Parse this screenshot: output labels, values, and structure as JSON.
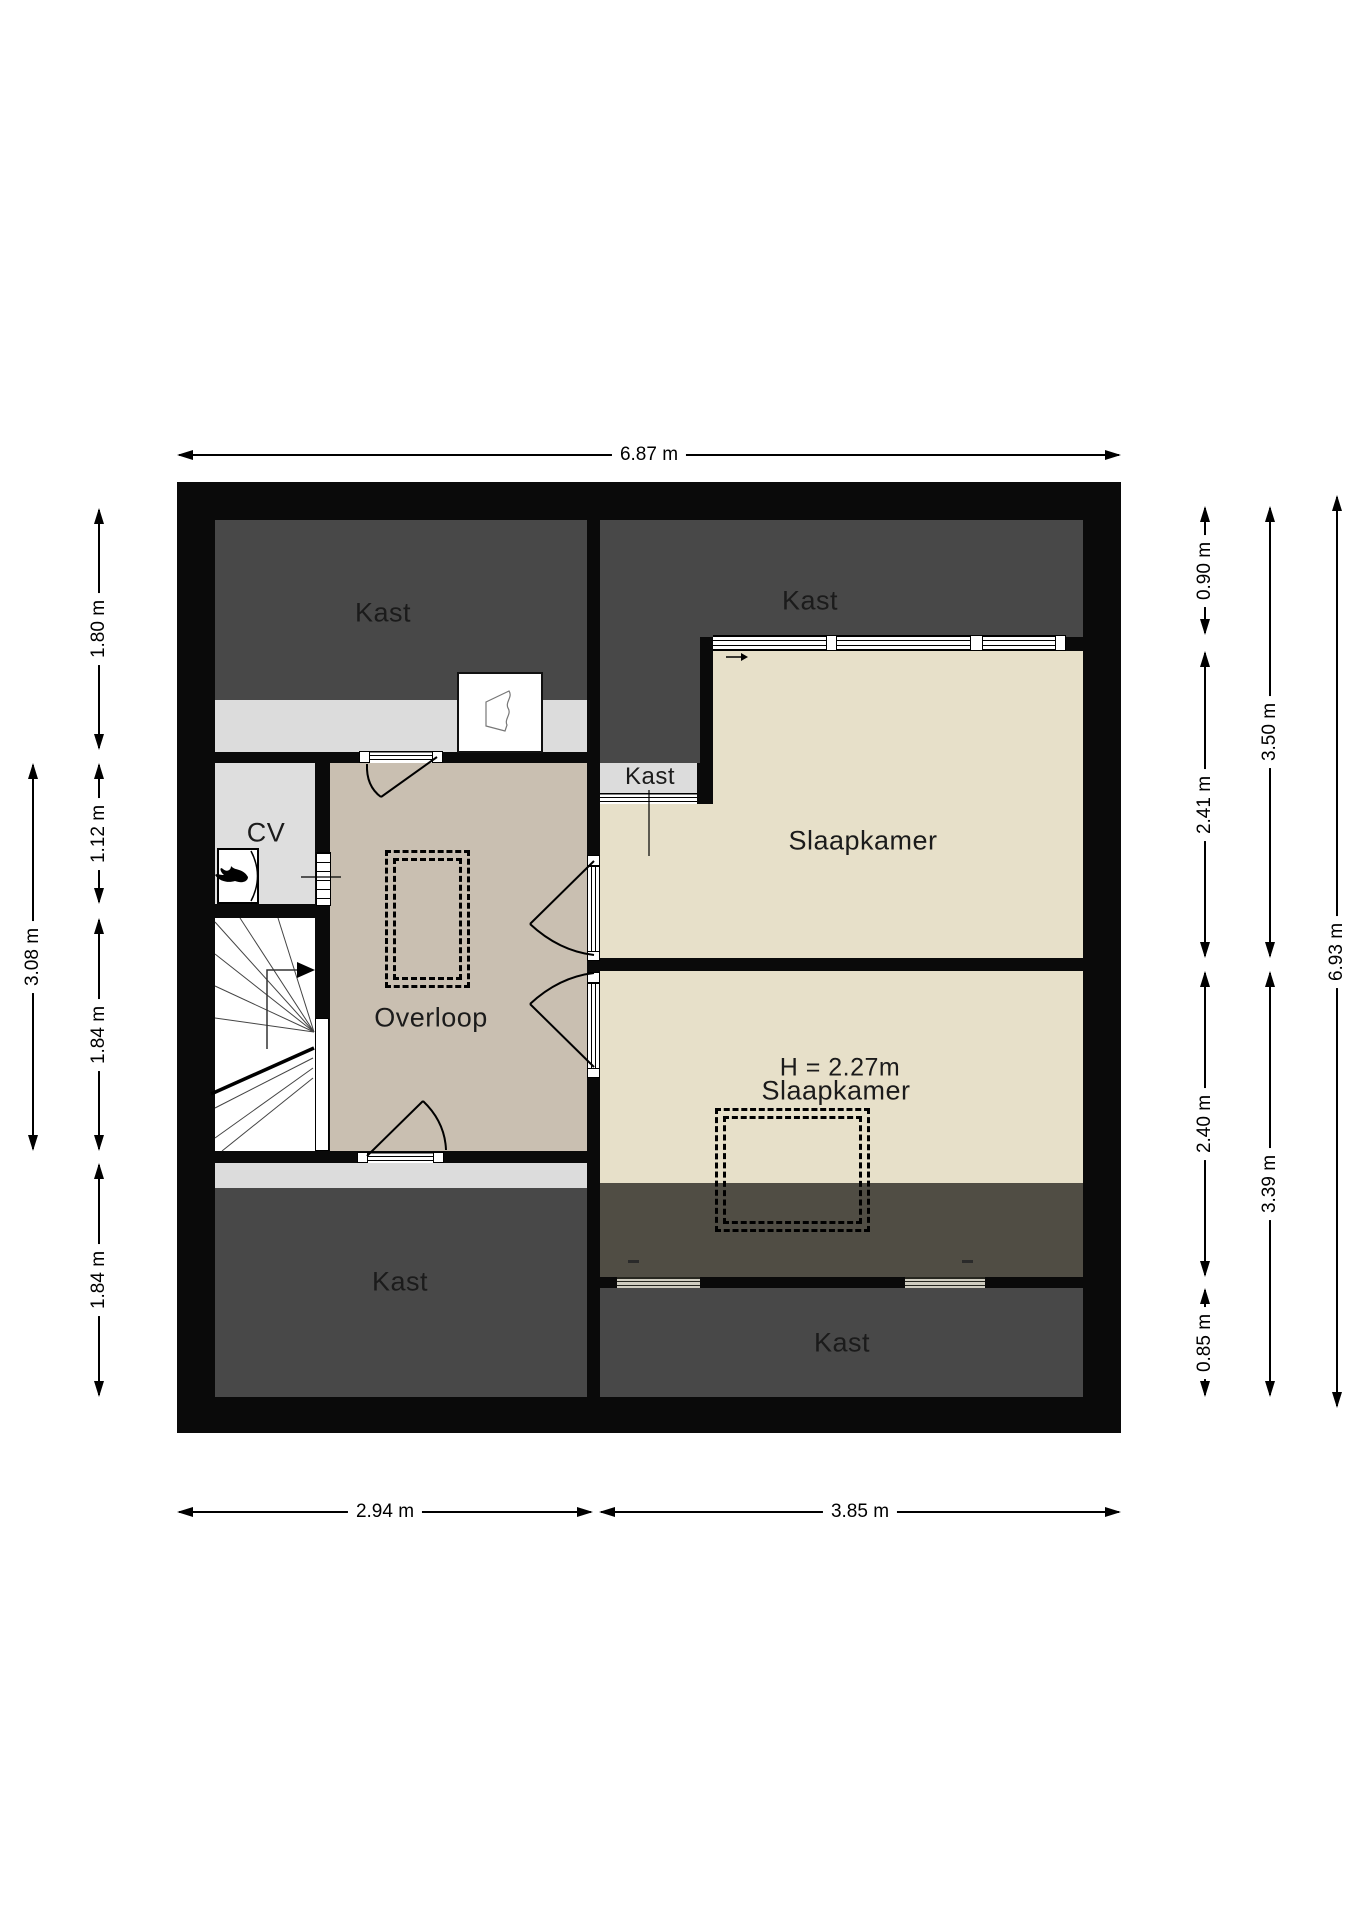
{
  "rooms": {
    "kast_top_left": "Kast",
    "kast_top_right": "Kast",
    "kast_small": "Kast",
    "cv": "CV",
    "overloop": "Overloop",
    "slaapkamer_top": "Slaapkamer",
    "slaapkamer_bottom_height": "H = 2.27m",
    "slaapkamer_bottom": "Slaapkamer",
    "kast_bottom_left": "Kast",
    "kast_bottom": "Kast"
  },
  "dimensions": {
    "top": [
      "6.87 m"
    ],
    "bottom": [
      "2.94 m",
      "3.85 m"
    ],
    "left_inner": [
      "1.80 m",
      "1.12 m",
      "1.84 m",
      "1.84 m"
    ],
    "left_outer": [
      "3.08 m"
    ],
    "right_inner": [
      "0.90 m",
      "2.41 m",
      "2.40 m",
      "0.85 m"
    ],
    "right_middle": [
      "3.50 m",
      "3.39 m"
    ],
    "right_outer": [
      "6.93 m"
    ]
  },
  "colors": {
    "wall": "#0a0a0a",
    "closet_dark": "#484848",
    "low_headroom_overlay": "#504d44",
    "sloped_ceiling_strip": "#dcdcdc",
    "landing_floor": "#c9bfb1",
    "bedroom_floor": "#e7e0c9"
  }
}
